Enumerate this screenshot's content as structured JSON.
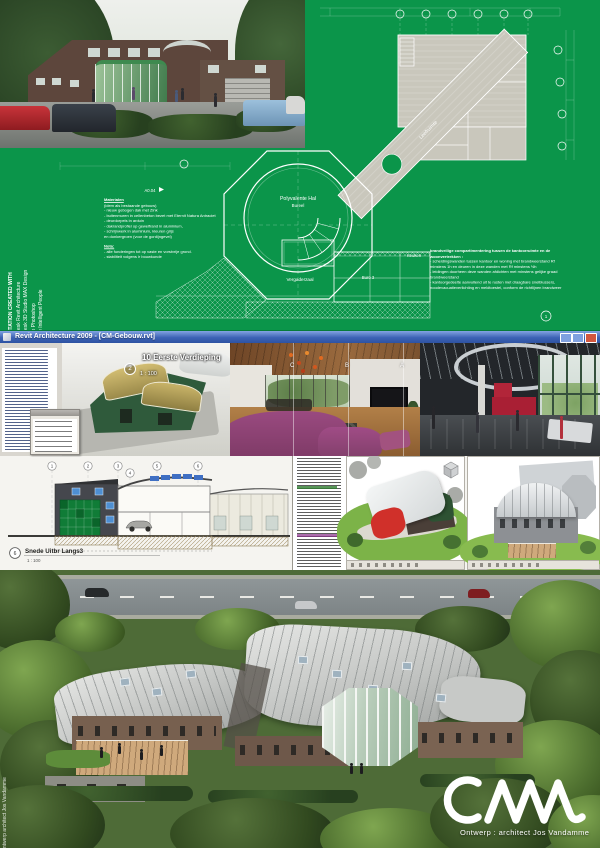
{
  "credits": {
    "heading": "PRESENTATION CREATED WITH",
    "tools": [
      "1 - Autodesk Revit Architecture",
      "2 - Autodesk 3D Studio MAX Design",
      "3 - Adobe Photoshop",
      "4 - A Few Intelligent People"
    ],
    "side_note": "Ontwerp architect Jos Vandamme"
  },
  "materials": {
    "title": "Materialen",
    "subtitle": "(idem als bestaande gebouw)",
    "items": [
      "- nieuw gebogen dak met Zink",
      "- buitenmuren in cellenbeton bezet met Eternit Natura Antraciet",
      "- deurdorpels in arduin",
      "- dakrandprofiel op gewelfrand in aluminium,",
      "- schrijnwerk in aluminium, kleuren grijs",
      "  en donkergroen (voor de gordijngevel)"
    ],
    "nota_title": "Nota:",
    "nota_items": [
      "- alle funderingen tot op vaste en vorstvrije grond.",
      "- stabiliteit volgens ir bouwkunde"
    ]
  },
  "fire_note": {
    "title": "brandveilige compartimentering tussen  de kantoorruimte en de woonvertrekken :",
    "items": [
      "- scheidingswanden tussen kantoor en woning met brandweerstand Rf minstens 1h en deuren in deze wanden met Rf minstens ½h",
      "- leidingen doorheen deze wanden afdichten met minstens gelijke graad brandweerstand",
      "- kantoorgedeelte aanvullend uit te rusten met draagbare snelblussers, noodevacuatieverlichting en meldtoestel, conform de richtlijnen brandweer"
    ]
  },
  "plan": {
    "room_labels": {
      "hall": "Polyvalente Hal",
      "hall2": "Bureel",
      "living": "Leefruimte",
      "meeting": "Vergaderzaal",
      "office": "Buro 3",
      "kitchen": "Keuken"
    },
    "sheet_ref": "A0.04",
    "grid_bubble_right": "1"
  },
  "cad": {
    "window_title": "Revit Architecture 2009 - [CM-Gebouw.rvt]",
    "view_number": "2",
    "view_label": "10 Eerste Verdieping",
    "view_scale": "1 : 100",
    "grid_letters": [
      "C",
      "B",
      "A"
    ]
  },
  "section_drawing": {
    "grid_numbers": [
      "1",
      "2",
      "3",
      "4",
      "5",
      "6"
    ],
    "view_number": "6",
    "label": "Snede Uitbr Langs3",
    "scale": "1 : 100"
  },
  "footer": {
    "credit": "Ontwerp : architect Jos Vandamme"
  },
  "colors": {
    "poster_green": "#0b954a",
    "titlebar_blue": "#3d63b5",
    "curtainwall_green": "#107c37",
    "window_blue": "#4e8fd2",
    "accent_red": "#b22539"
  }
}
